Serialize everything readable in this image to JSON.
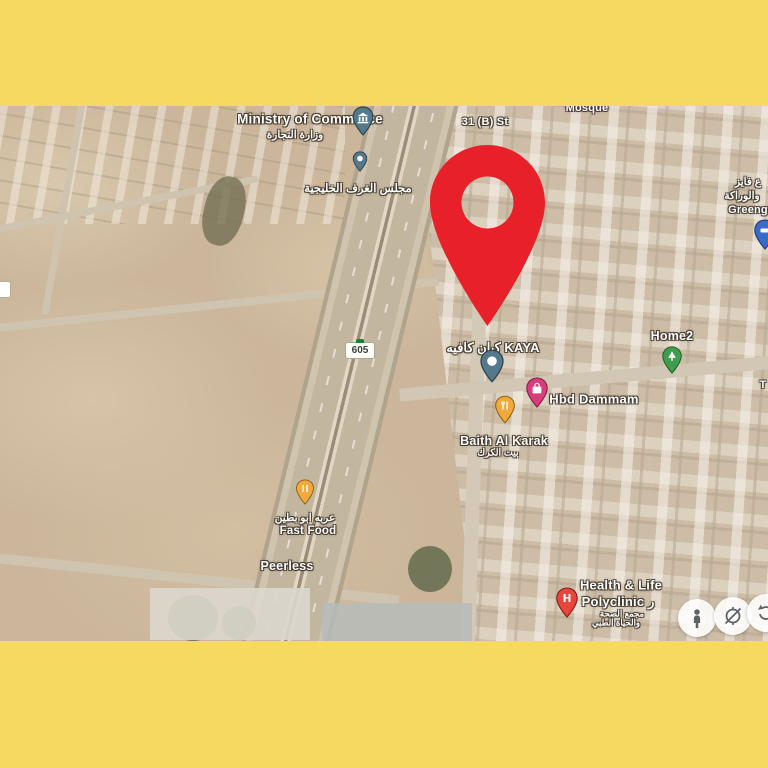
{
  "frame": {
    "background_color": "#F6D960"
  },
  "map": {
    "route_shield": {
      "number": "605"
    },
    "street_names": {
      "st_31b": "31 (B) St",
      "t_partial": "T"
    },
    "pois": {
      "mosque": {
        "label": "Mosque"
      },
      "ministry": {
        "label": "Ministry of Commerce",
        "label_ar": "وزارة التجارة"
      },
      "gulf_chambers": {
        "label_ar": "مجلس الغرف الخليجية"
      },
      "right_edge_shop": {
        "line1_ar": "ع فايز",
        "line2_ar": "والوراكة",
        "line3": "Greeng"
      },
      "kaya_cafe": {
        "label": "كيان كافيه KAYA"
      },
      "hbd_dammam": {
        "label": "Hbd Dammam"
      },
      "baith_al_karak": {
        "label": "Baith Al Karak",
        "label_ar": "بيت الكرك"
      },
      "home2": {
        "label": "Home2"
      },
      "fast_food": {
        "label_ar": "عربه ابو بطين",
        "label": "Fast Food"
      },
      "peerless": {
        "label": "Peerless"
      },
      "polyclinic": {
        "line1": "Health & Life",
        "line2": "Polyclinic ر",
        "ar1": "مجمع الصحة",
        "ar2": "والحياة الطبي"
      }
    },
    "marker_colors": {
      "destination_red": "#E8202A",
      "government_teal": "#54788C",
      "shopping_pink": "#DB3D7C",
      "food_yellow": "#F2A93B",
      "park_green": "#3E9E4E",
      "hospital_red": "#E8453C",
      "poi_blue": "#3B6BC7"
    },
    "hospital_glyph": "H"
  }
}
